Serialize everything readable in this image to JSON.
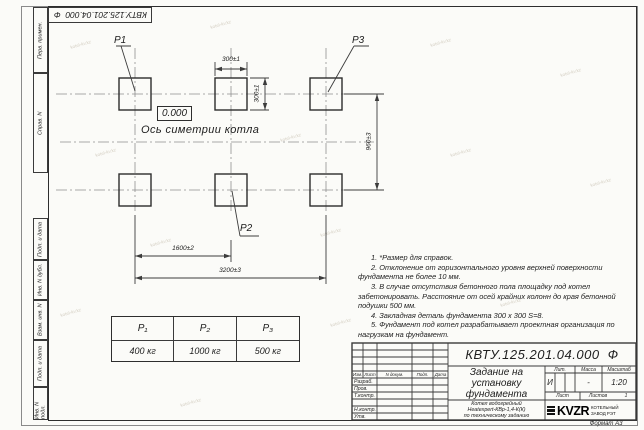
{
  "watermark": "kotel-kv.kz",
  "corner_stamp": "КВТУ.125.201.04.000  Ф",
  "margin_labels": {
    "perv": "Перв. примен.",
    "sprav": "Справ. N",
    "podp1": "Подп. и дата",
    "inv_dubl": "Инв. N дубл.",
    "vzam": "Взам. инв. N",
    "podp2": "Подп. и дата",
    "inv_podl": "Инв. N подл."
  },
  "drawing": {
    "labels": {
      "p1": "P1",
      "p2": "P2",
      "p3": "P3"
    },
    "elevation": "0.000",
    "axis": "Ось симетрии котла",
    "dims": {
      "top_w": "300±1",
      "side_h": "300±1",
      "row_gap": "960±3",
      "col_gap": "1600±2",
      "total": "3200±3"
    }
  },
  "notes": [
    "1. *Размер для справок.",
    "2. Отклонение от горизонтального уровня верхней поверхности фундамента не более 10 мм.",
    "3. В случае отсутствия бетонного пола площадку под котел забетонировать. Расстояние от осей крайних колонн до края бетонной подушки 500 мм.",
    "4. Закладная деталь фундамента  300 х 300  S=8.",
    "5. Фундамент под котел разрабатывает проектная организация по нагрузкам на фундамент."
  ],
  "load_table": {
    "headers": [
      "P₁",
      "P₂",
      "P₃"
    ],
    "values": [
      "400 кг",
      "1000 кг",
      "500 кг"
    ]
  },
  "title_block": {
    "doc_number": "КВТУ.125.201.04.000  Ф",
    "title": [
      "Задание на",
      "установку",
      "фундамента"
    ],
    "product": [
      "Котел водогрейный",
      "Heatexpert-КВр-1,4-К(К)",
      "по техническому заданию"
    ],
    "cols": [
      "Изм.",
      "Лист",
      "N докум.",
      "Подп.",
      "Дата"
    ],
    "rows": [
      "Разраб.",
      "Пров.",
      "Т.контр.",
      "Н.контр.",
      "Утв."
    ],
    "lit_label": "Лит.",
    "lit_value": "И",
    "mass_label": "Масса",
    "mass_value": "-",
    "scale_label": "Масштаб",
    "scale_value": "1:20",
    "sheet_label": "Лист",
    "sheets_label": "Листов",
    "sheets_value": "1",
    "logo": "KVZR",
    "company": [
      "КОТЕЛЬНЫЙ",
      "ЗАВОД РЭТ"
    ],
    "format": "Формат А3"
  }
}
